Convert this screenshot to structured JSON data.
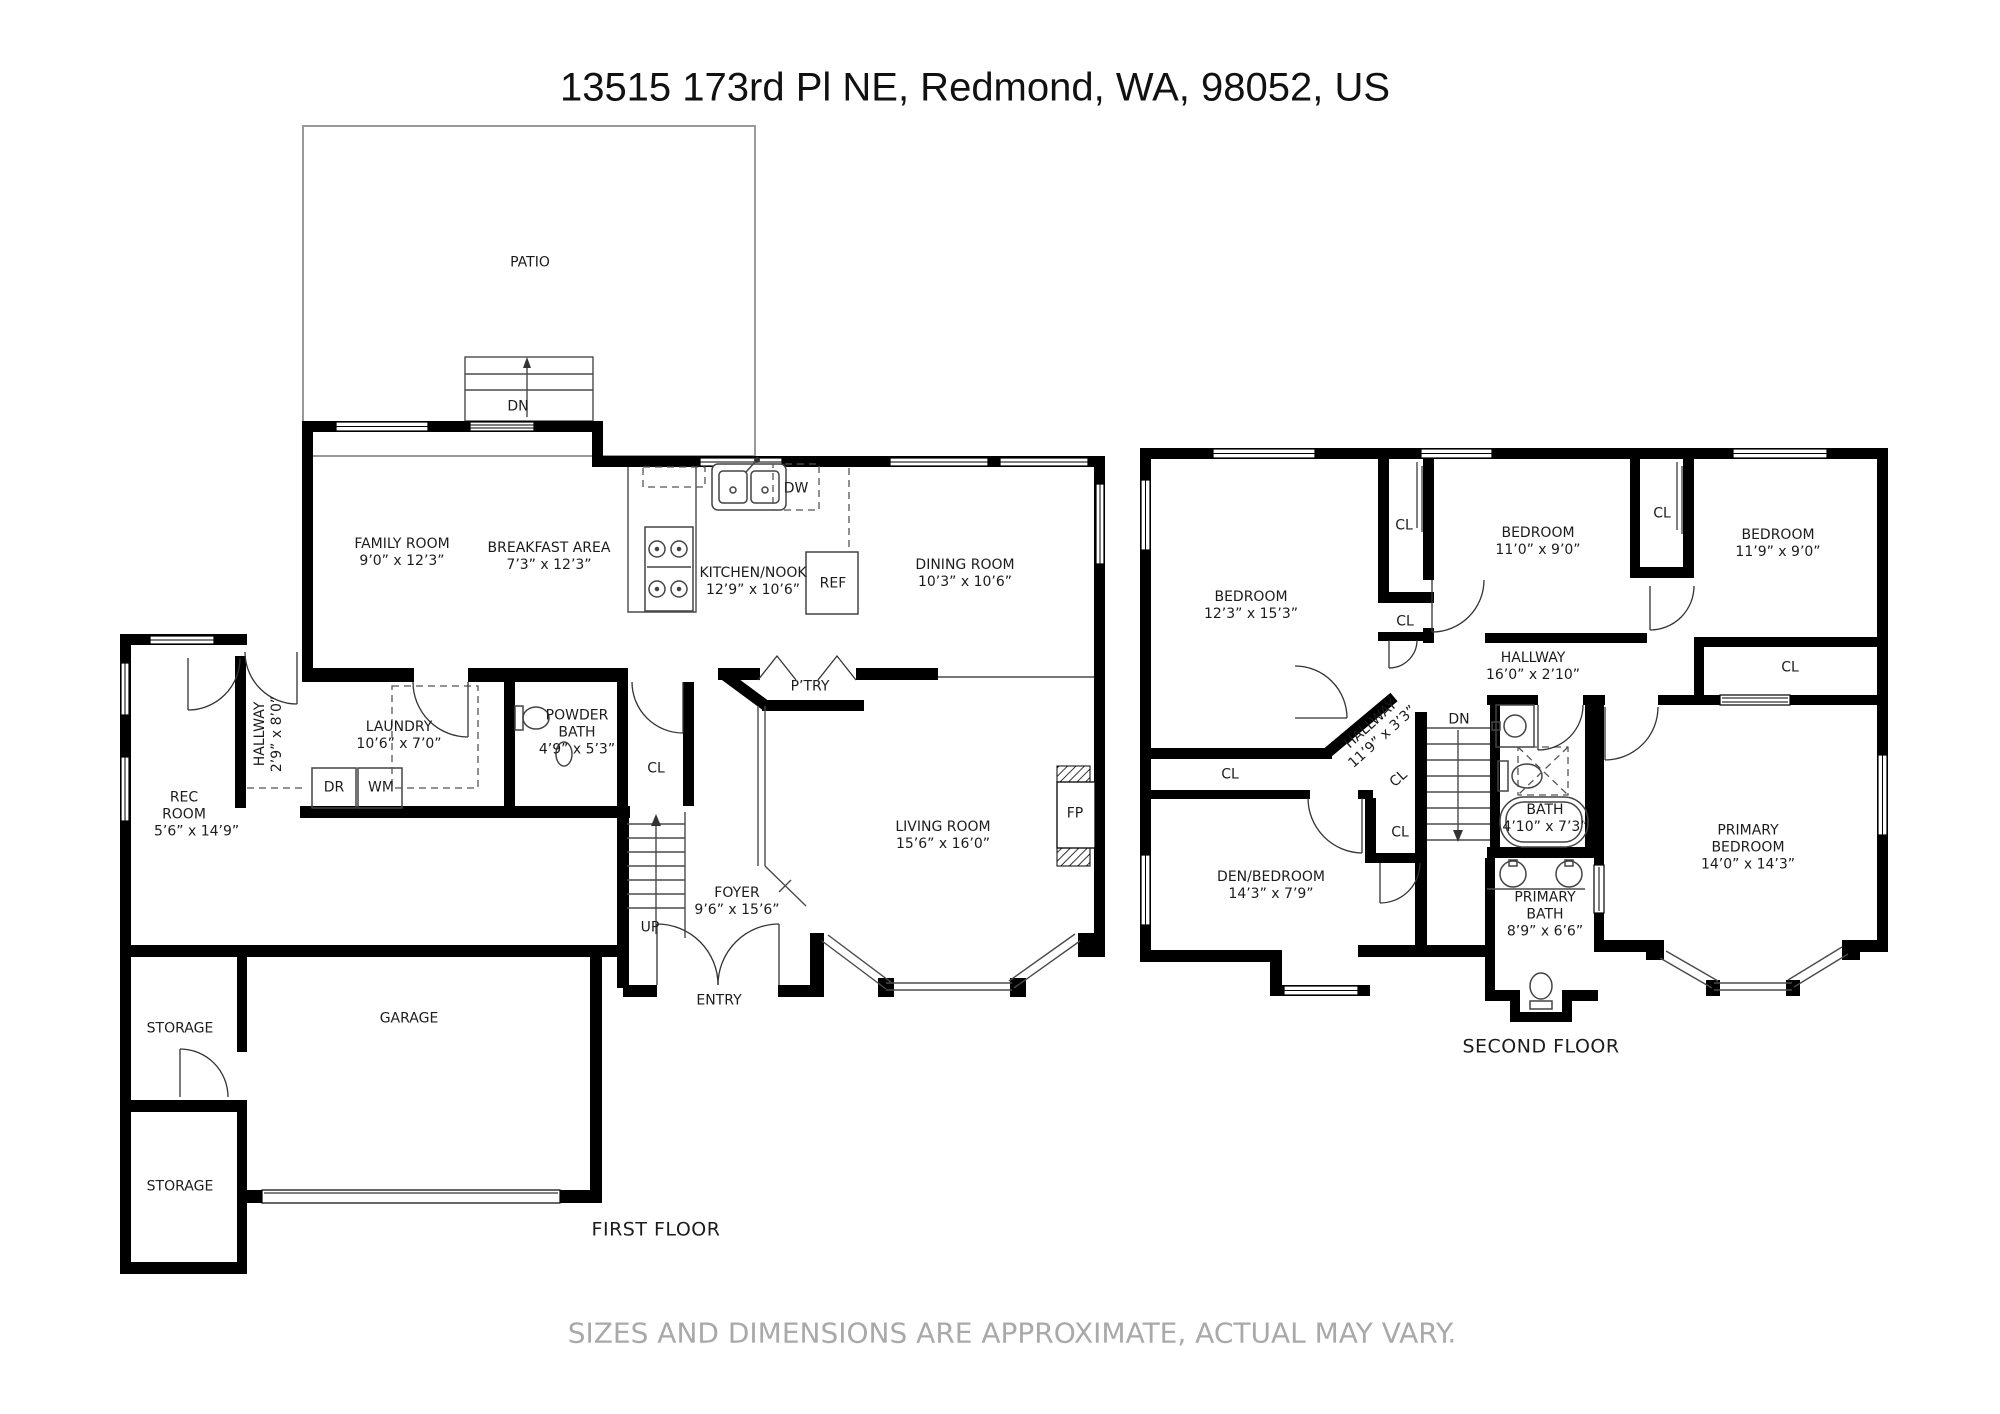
{
  "title": "13515 173rd Pl NE, Redmond, WA, 98052, US",
  "disclaimer": "SIZES AND DIMENSIONS ARE APPROXIMATE, ACTUAL MAY VARY.",
  "first_floor": {
    "caption": "FIRST FLOOR",
    "rooms": {
      "patio": {
        "name": "PATIO"
      },
      "family_room": {
        "name": "FAMILY ROOM",
        "dims": "9’0” x 12’3”"
      },
      "breakfast_area": {
        "name": "BREAKFAST AREA",
        "dims": "7’3” x 12’3”"
      },
      "kitchen_nook": {
        "name": "KITCHEN/NOOK",
        "dims": "12’9” x 10’6”"
      },
      "dining_room": {
        "name": "DINING ROOM",
        "dims": "10’3” x 10’6”"
      },
      "hallway": {
        "name": "HALLWAY",
        "dims": "2’9” x 8’0”"
      },
      "laundry": {
        "name": "LAUNDRY",
        "dims": "10’6” x 7’0”"
      },
      "powder_bath": {
        "name": "POWDER BATH",
        "dims": "4’9” x 5’3”"
      },
      "rec_room": {
        "name": "REC ROOM",
        "dims": "5’6” x 14’9”"
      },
      "living_room": {
        "name": "LIVING ROOM",
        "dims": "15’6” x 16’0”"
      },
      "foyer": {
        "name": "FOYER",
        "dims": "9’6” x 15’6”"
      },
      "garage": {
        "name": "GARAGE"
      },
      "storage_upper": {
        "name": "STORAGE"
      },
      "storage_lower": {
        "name": "STORAGE"
      },
      "pantry": {
        "name": "P’TRY"
      },
      "entry": {
        "name": "ENTRY"
      }
    },
    "markers": {
      "stairs_down": "DN",
      "stairs_up": "UP",
      "closet": "CL",
      "fireplace": "FP",
      "dryer": "DR",
      "washer": "WM",
      "dishwasher": "DW",
      "refrigerator": "REF"
    }
  },
  "second_floor": {
    "caption": "SECOND FLOOR",
    "rooms": {
      "bedroom_left": {
        "name": "BEDROOM",
        "dims": "12’3” x 15’3”"
      },
      "bedroom_middle": {
        "name": "BEDROOM",
        "dims": "11’0” x 9’0”"
      },
      "bedroom_right": {
        "name": "BEDROOM",
        "dims": "11’9” x 9’0”"
      },
      "hallway_main": {
        "name": "HALLWAY",
        "dims": "16’0” x 2’10”"
      },
      "hallway_diagonal": {
        "name": "HALLWAY",
        "dims": "11’9” x 3’3”"
      },
      "bath": {
        "name": "BATH",
        "dims": "4’10” x 7’3”"
      },
      "primary_bath": {
        "name": "PRIMARY BATH",
        "dims": "8’9” x 6’6”"
      },
      "den_bedroom": {
        "name": "DEN/BEDROOM",
        "dims": "14’3” x 7’9”"
      },
      "primary_bedroom": {
        "name": "PRIMARY BEDROOM",
        "dims": "14’0” x 14’3”"
      }
    },
    "markers": {
      "stairs_down": "DN",
      "closet": "CL"
    }
  }
}
